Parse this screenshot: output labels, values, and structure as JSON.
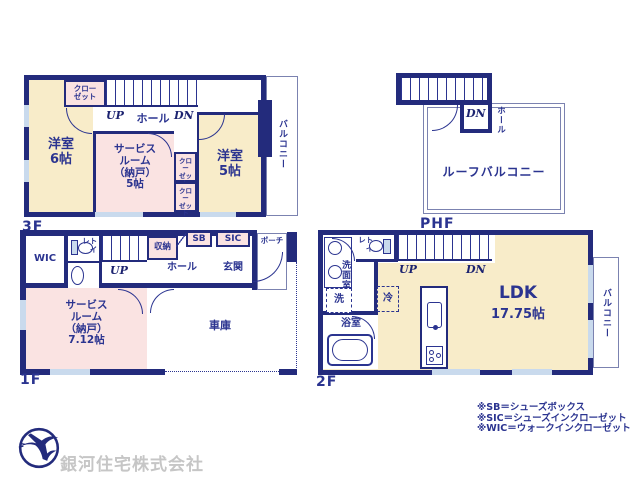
{
  "colors": {
    "wall_navy": "#232b7c",
    "room_cream": "#f8ecc9",
    "room_pink": "#fae3e2",
    "thin_line": "#7b82b0",
    "text_navy": "#2b3490",
    "window_blue": "#c9daed",
    "company_gray": "#c6c6c6"
  },
  "floors": {
    "f3": {
      "label": "3F",
      "room_west6": "洋室\n6帖",
      "closet_top": "クロー\nゼット",
      "up": "UP",
      "dn": "DN",
      "hall": "ホール",
      "service_room": "サービス\nルーム\n（納戸）\n5帖",
      "closet_a": "クロー\nゼット",
      "closet_b": "クロー\nゼット",
      "room_west5": "洋室\n5帖",
      "balcony": "バルコニー"
    },
    "phf": {
      "label": "PHF",
      "dn": "DN",
      "hall": "ホール",
      "roof_balcony": "ルーフバルコニー"
    },
    "f1": {
      "label": "1F",
      "wic": "WIC",
      "toilet": "トイレ",
      "up": "UP",
      "storage": "収納",
      "sb": "SB",
      "sic": "SIC",
      "porch": "ポーチ",
      "hall": "ホール",
      "entrance": "玄関",
      "service_room": "サービス\nルーム\n（納戸）\n7.12帖",
      "garage": "車庫"
    },
    "f2": {
      "label": "2F",
      "toilet": "トイレ",
      "up": "UP",
      "dn": "DN",
      "washroom": "洗面室",
      "laundry": "洗",
      "bath": "浴室",
      "fridge": "冷",
      "ldk_name": "LDK",
      "ldk_size": "17.75帖",
      "balcony": "バルコニー"
    }
  },
  "footer": {
    "legend": [
      "※SB＝シューズボックス",
      "※SIC＝シューズインクローゼット",
      "※WIC＝ウォークインクローゼット"
    ],
    "company": "銀河住宅株式会社"
  }
}
